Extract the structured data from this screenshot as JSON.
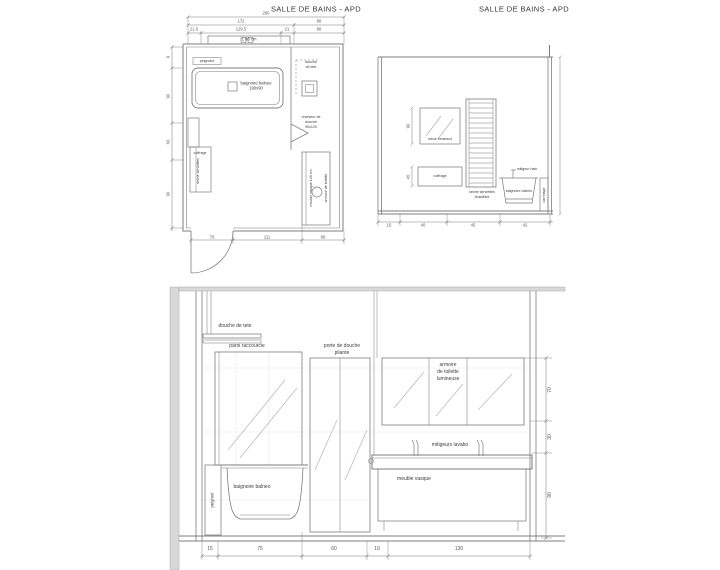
{
  "titles": {
    "plan": "SALLE DE BAINS - APD",
    "elevation": "SALLE DE BAINS - APD"
  },
  "colors": {
    "line": "#7d7d7d",
    "shade": "#d8d8d8",
    "text": "#3c3c3c"
  },
  "plan": {
    "niche_note": "± 98 cm",
    "labels": {
      "peignoirs": "peignoirs",
      "baignoire_line1": "baignoire balneo",
      "baignoire_line2": "190x90",
      "douche_tete_line1": "douche",
      "douche_tete_line2": "de tete",
      "receveur_line1": "receveur de",
      "receveur_line2": "douche",
      "receveur_line3": "90x120",
      "coffrage": "coffrage",
      "seche_serviettes": "seche serviettes",
      "meuble_vasque": "meuble vasque 140 cm",
      "armoire": "armoire de toilette"
    },
    "dims": {
      "total": "260",
      "row2": [
        "172",
        "88"
      ],
      "row3": [
        "21.5",
        "129.5",
        "21",
        "88"
      ],
      "left": [
        "9",
        "90",
        "60",
        "90"
      ],
      "bottom": [
        "70",
        "111",
        "68"
      ]
    }
  },
  "side_elevation": {
    "labels": {
      "miroir": "miroir lumineux",
      "seche_line1": "seche serviettes",
      "seche_line2": "chauffant",
      "coffrage": "coffrage",
      "baignoire": "baignoire balneo",
      "mitigeur": "mitigeur bain",
      "carrelage": "carrelage"
    },
    "dims": {
      "mirror_height": "90",
      "coffrage_height": "45",
      "bottom": [
        "15",
        "40",
        "45",
        "42"
      ]
    }
  },
  "main_elevation": {
    "labels": {
      "douche_de_tete": "douche de tete",
      "paroi": "paroi raccourcie",
      "porte_line1": "porte de douche",
      "porte_line2": "pliante",
      "armoire_line1": "armoire",
      "armoire_line2": "de toilette",
      "armoire_line3": "lumineuse",
      "mitigeurs": "mitigeurs lavabo",
      "meuble_vasque": "meuble vasque",
      "baignoire": "baignoire balneo",
      "peignoir": "peignoir"
    },
    "dims": {
      "bottom": [
        "15",
        "75",
        "60",
        "19",
        "130"
      ],
      "right": [
        "70",
        "30",
        "90"
      ]
    }
  }
}
